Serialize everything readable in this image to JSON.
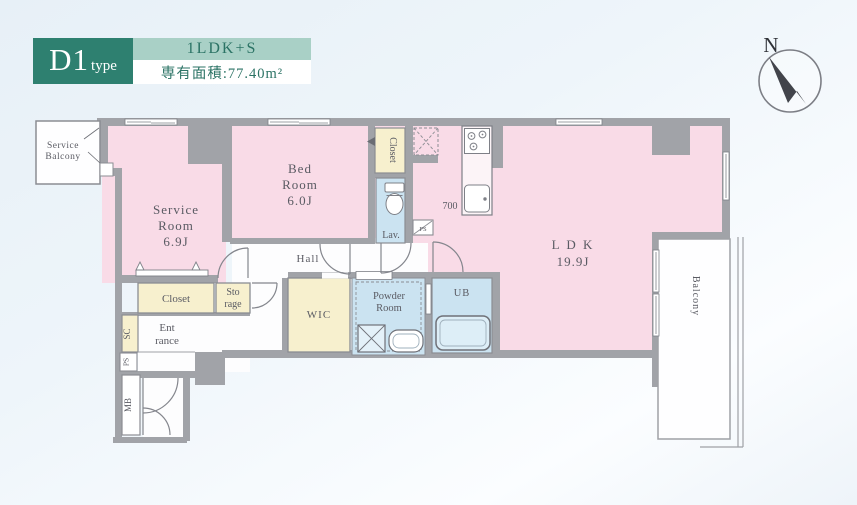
{
  "header": {
    "type_main": "D1",
    "type_suffix": "type",
    "layout": "1LDK+S",
    "area": "専有面積:77.40m²"
  },
  "compass": {
    "north": "N"
  },
  "plan": {
    "labels": {
      "service_balcony": [
        "Service",
        "Balcony"
      ],
      "service_room": [
        "Service",
        "Room",
        "6.9J"
      ],
      "bed_room": [
        "Bed",
        "Room",
        "6.0J"
      ],
      "ldk": [
        "L D K",
        "19.9J"
      ],
      "closet_bedroom": "Closet",
      "closet_hall": "Closet",
      "storage": [
        "Sto",
        "rage"
      ],
      "sc": "SC",
      "entrance": [
        "Ent",
        "rance"
      ],
      "ps_left": "PS",
      "ps_lav": "PS",
      "mb": "MB",
      "wic": "WIC",
      "powder_room": [
        "Powder",
        "Room"
      ],
      "ub": "UB",
      "lav": "Lav.",
      "hall": "Hall",
      "balcony": "Balcony",
      "dim_700": "700"
    }
  },
  "colors": {
    "accent_dark": "#2E8070",
    "accent_light": "#A9D0C6",
    "room_pink": "#F9DBE7",
    "closet_cream": "#F7F0CE",
    "wet_blue": "#CBE3F1",
    "wall_gray": "#A1A3A8",
    "label_gray": "#5A5B63"
  }
}
